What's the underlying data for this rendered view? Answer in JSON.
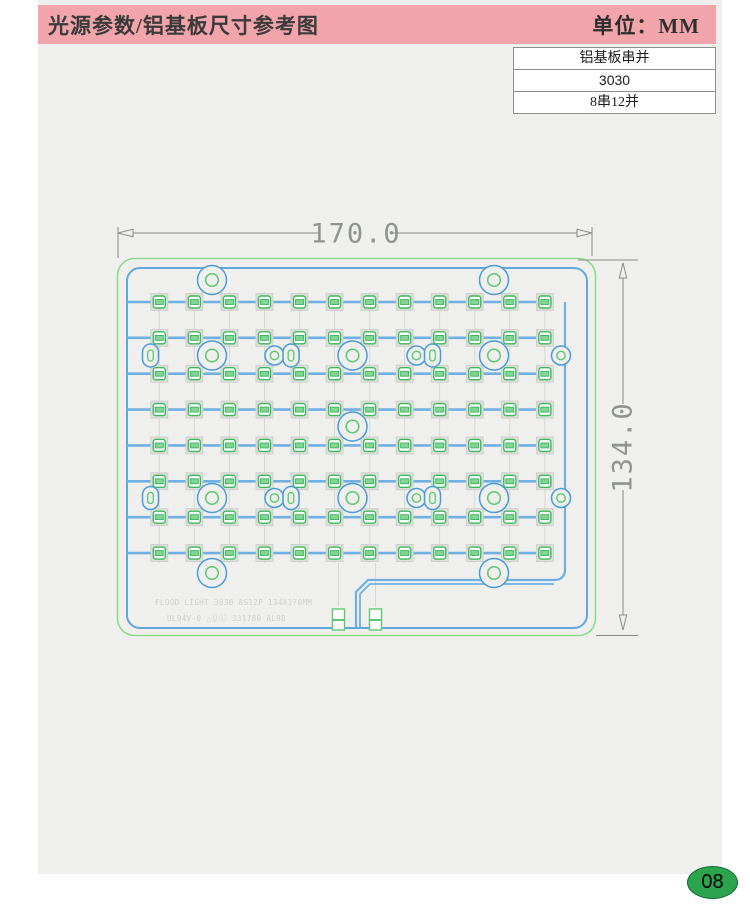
{
  "page": {
    "title": "光源参数/铝基板尺寸参考图",
    "unit_label": "单位：MM",
    "page_number": "08"
  },
  "spec_table": {
    "rows": [
      "铝基板串并",
      "3030",
      "8串12并"
    ]
  },
  "drawing": {
    "width_label": "170.0",
    "height_label": "134.0",
    "silkscreen_line1": "FLOOD LIGHT 3030 8S12P 134X170MM",
    "silkscreen_line2": "UL94V-0 △ⓊⓁ 331780 AL88",
    "led_grid": {
      "rows": 8,
      "cols": 12,
      "col_start": 159.3,
      "col_step": 35.05,
      "row_start": 302,
      "row_step": 35.86
    },
    "holes": [
      {
        "t": "big",
        "x": 212,
        "y": 280
      },
      {
        "t": "big",
        "x": 494,
        "y": 280
      },
      {
        "t": "oval",
        "x": 150.5,
        "y": 355.5
      },
      {
        "t": "big",
        "x": 212,
        "y": 355.5
      },
      {
        "t": "circ",
        "x": 274.5,
        "y": 355.5
      },
      {
        "t": "oval",
        "x": 291,
        "y": 355.5
      },
      {
        "t": "big",
        "x": 352.5,
        "y": 355.5
      },
      {
        "t": "circ",
        "x": 416.5,
        "y": 355.5
      },
      {
        "t": "oval",
        "x": 432.5,
        "y": 355.5
      },
      {
        "t": "big",
        "x": 494,
        "y": 355.5
      },
      {
        "t": "circ",
        "x": 561,
        "y": 355.5
      },
      {
        "t": "big",
        "x": 352.5,
        "y": 426.5
      },
      {
        "t": "oval",
        "x": 150.5,
        "y": 498
      },
      {
        "t": "big",
        "x": 212,
        "y": 498
      },
      {
        "t": "circ",
        "x": 274.5,
        "y": 498
      },
      {
        "t": "oval",
        "x": 291,
        "y": 498
      },
      {
        "t": "big",
        "x": 352.5,
        "y": 498
      },
      {
        "t": "circ",
        "x": 416.5,
        "y": 498
      },
      {
        "t": "oval",
        "x": 432.5,
        "y": 498
      },
      {
        "t": "big",
        "x": 494,
        "y": 498
      },
      {
        "t": "circ",
        "x": 561,
        "y": 498
      },
      {
        "t": "big",
        "x": 212,
        "y": 573
      },
      {
        "t": "big",
        "x": 494,
        "y": 573
      }
    ],
    "connector_pads": [
      {
        "x": 332.5,
        "y": 609
      },
      {
        "x": 369.5,
        "y": 609
      }
    ],
    "colors": {
      "header_pink": "#f2a4ab",
      "content_bg": "#efefed",
      "board_green_outline": "#8cdc8c",
      "board_blue": "#5fa8dc",
      "trace_blue": "#6fb0e2",
      "led_green": "#3cb85c",
      "led_fill": "#7fd695",
      "pad_gray": "#dcded9",
      "hole_blue": "#4a9bd8",
      "hole_green": "#5cc873",
      "dim_gray": "#8a8a8a",
      "dim_text": "#8f9492",
      "silkscreen_gray": "#cbd0cb",
      "badge_green": "#2ca44e"
    }
  }
}
